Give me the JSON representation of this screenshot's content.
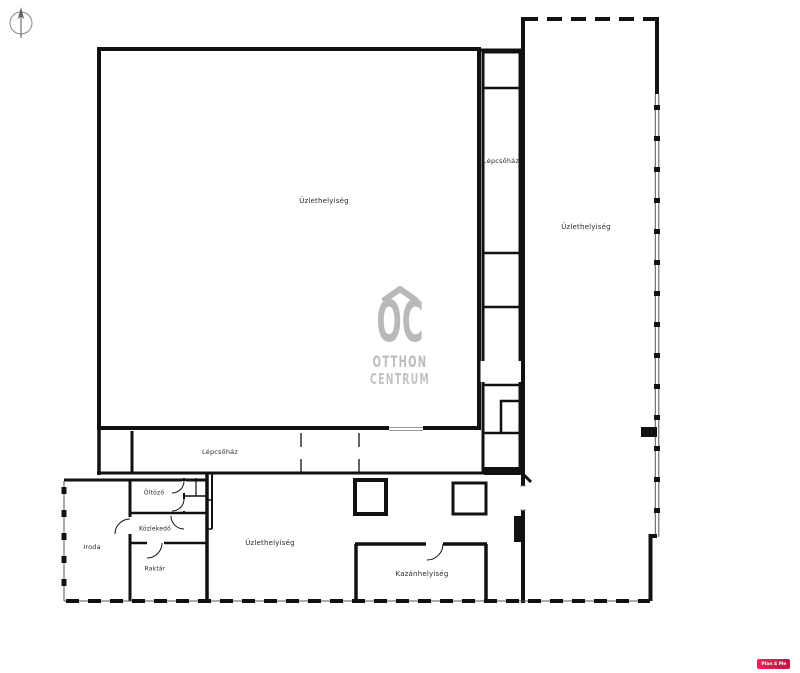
{
  "plan": {
    "rooms": {
      "main_hall": "Üzlethelyiség",
      "stairwell_upper": "Lépcsőház",
      "right_hall": "Üzlethelyiség",
      "stairwell_lower": "Lépcsőház",
      "dressing_room": "Öltöző",
      "corridor": "Közlekedő",
      "office": "Iroda",
      "storage": "Raktár",
      "lower_hall": "Üzlethelyiség",
      "boiler_room": "Kazánhelyiség"
    }
  },
  "watermark": {
    "monogram": "OC",
    "line1": "OTTHON",
    "line2": "CENTRUM",
    "color": "#b9b9b9"
  },
  "badge": {
    "text": "Plan 4 Me",
    "background": "#e0164f",
    "text_color": "#ffffff"
  },
  "icons": {
    "compass_icon": "north-arrow"
  },
  "colors": {
    "walls": "#111111",
    "labels": "#2a2a2a",
    "background": "#ffffff"
  }
}
